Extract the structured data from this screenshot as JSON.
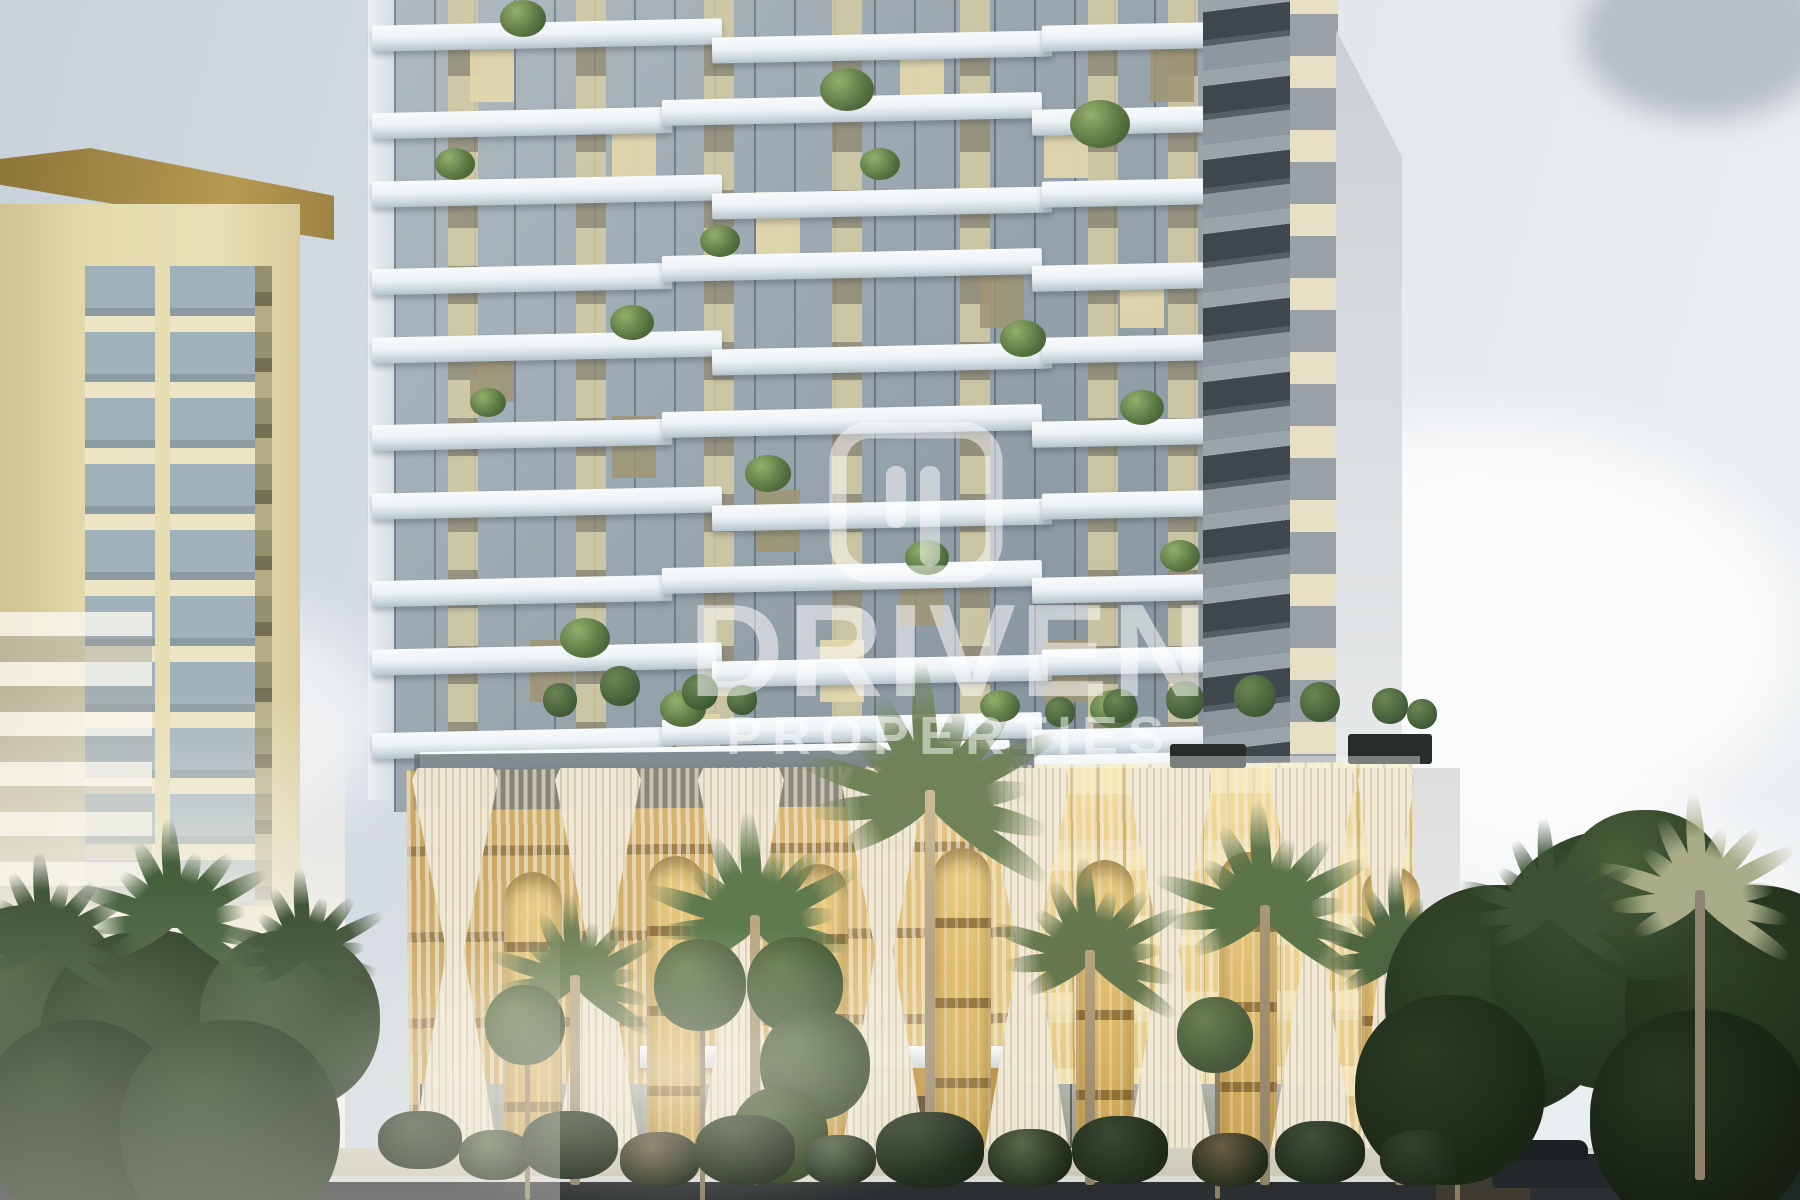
{
  "watermark": {
    "line1": "DRIVEN",
    "line2": "PROPERTIES",
    "logo": "driven-properties-logo",
    "text_color": "#ffffff"
  },
  "palette": {
    "sky_top": "#c9d2db",
    "sky_right": "#edf0f2",
    "glass": "#9aa8b2",
    "mullion": "#515c64",
    "slab": "#eef3f6",
    "slab_shadow": "#b6c3cb",
    "cream": "#ddd2a6",
    "khaki": "#a09678",
    "left_tower": "#e4daad",
    "cornice": "#8a7538",
    "cornice_light": "#b79a52",
    "wing_dark": "#3f474e",
    "wing_cream": "#e7dfc6",
    "side_wall": "#cbd0d4",
    "podium_gold": "#d9b366",
    "podium_gold_light": "#eed691",
    "podium_floor": "#8d6d36",
    "lattice": "#f2ecdc",
    "green_dark": "#2f4129",
    "green_mid": "#4f6b3f",
    "green_light": "#72885c",
    "trunk": "#c3b08e",
    "ground": "#c6c1b1",
    "road": "#2c2f31"
  }
}
